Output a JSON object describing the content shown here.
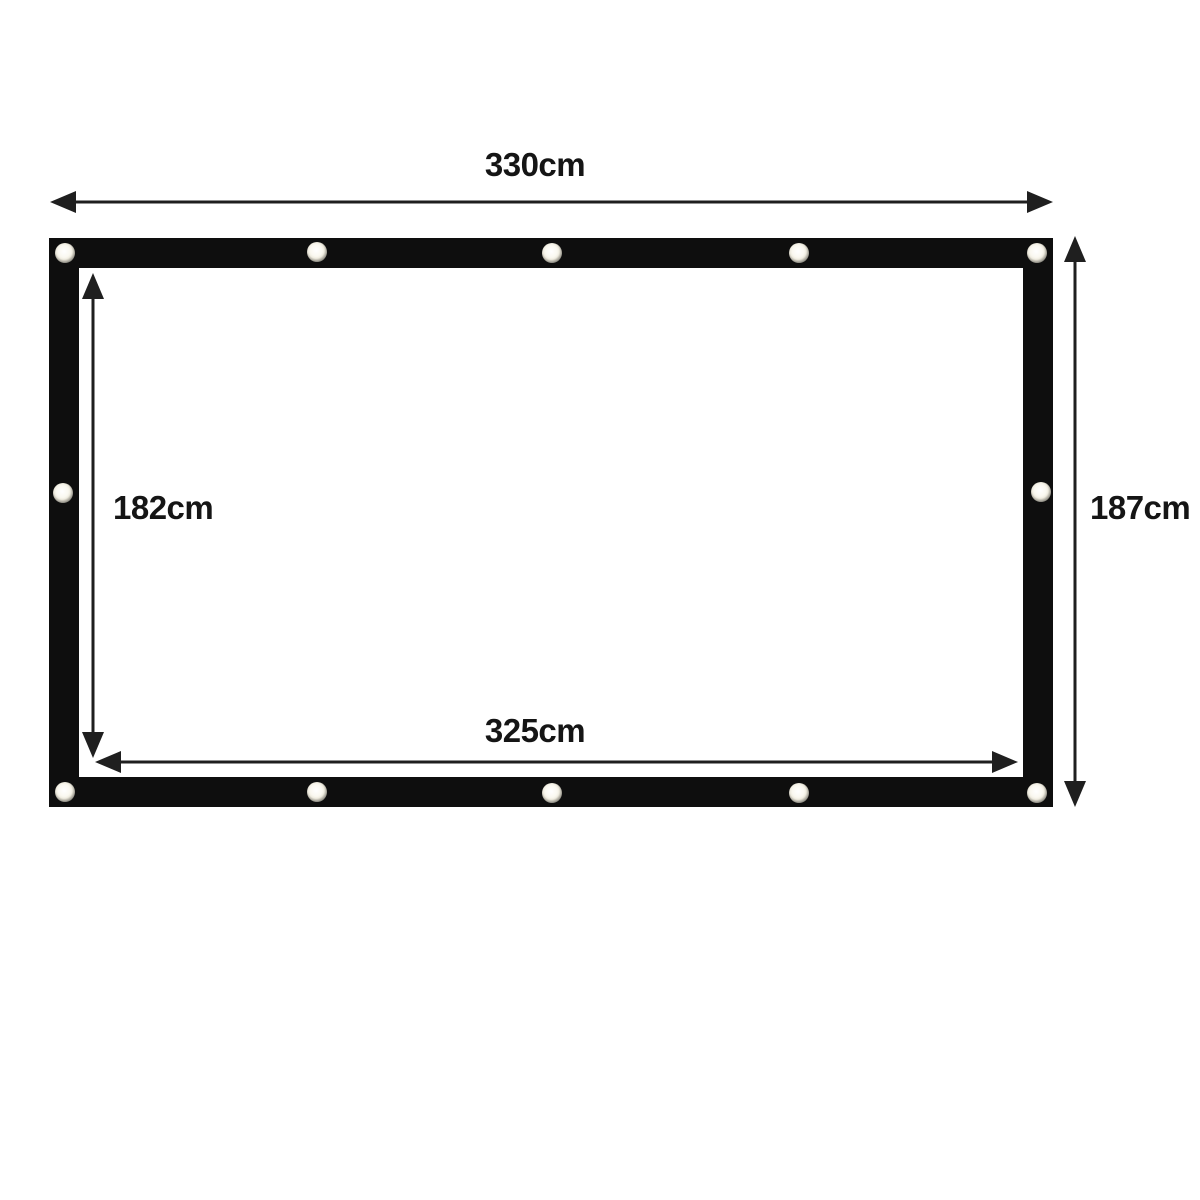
{
  "diagram": {
    "kind": "screen-dimension-diagram",
    "labels": {
      "outer_width": "330cm",
      "outer_height": "187cm",
      "inner_height": "182cm",
      "inner_width": "325cm"
    },
    "colors": {
      "background": "#ffffff",
      "frame": "#0e0e0e",
      "arrow": "#1f1f1f",
      "text": "#151515",
      "grommet_center": "#faf8f0",
      "grommet_ring": "#7d7c74"
    },
    "grommet_count": 12
  }
}
